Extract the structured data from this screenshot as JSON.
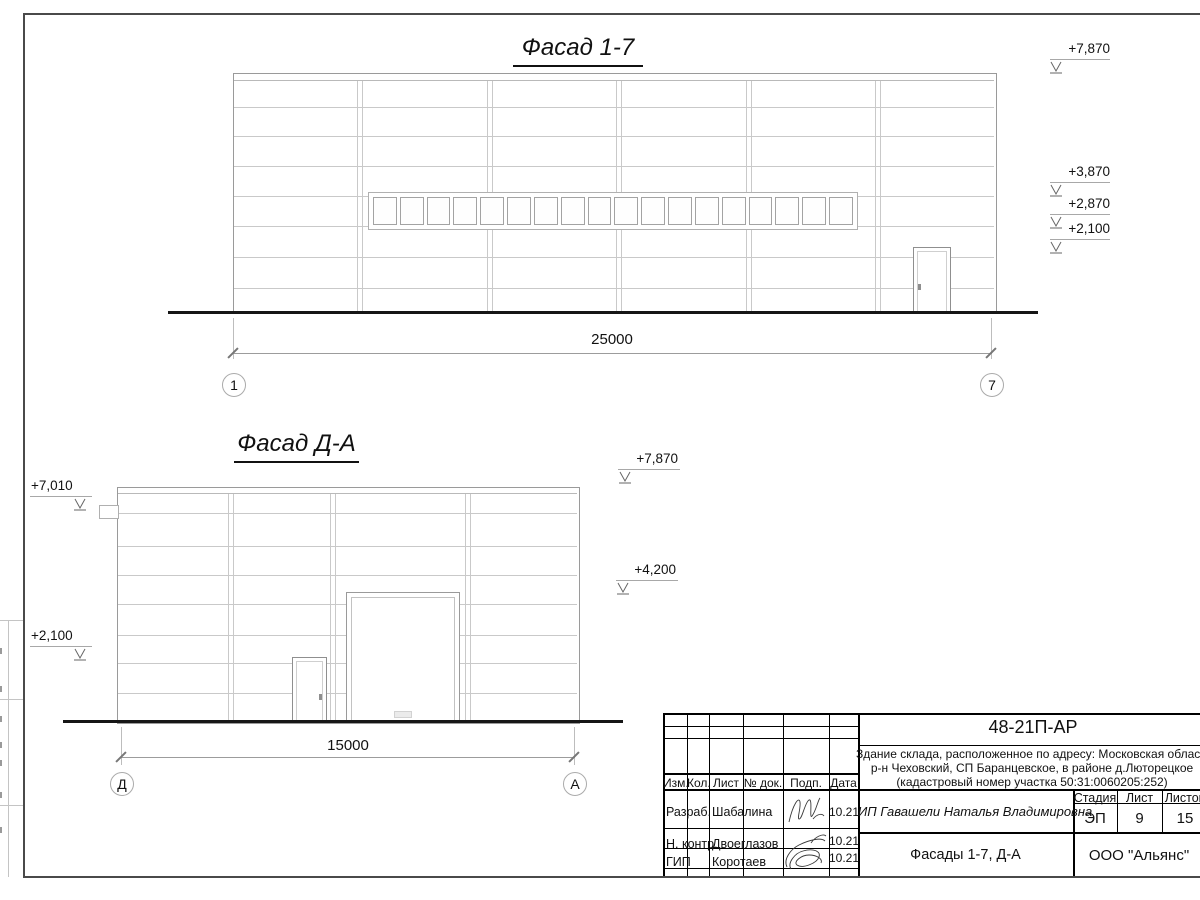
{
  "facade_top": {
    "title": "Фасад 1-7",
    "dimension": "25000",
    "axis_left": "1",
    "axis_right": "7",
    "elev_roof": "+7,870",
    "elev_1": "+3,870",
    "elev_2": "+2,870",
    "elev_3": "+2,100",
    "window_panes": 18
  },
  "facade_side": {
    "title": "Фасад Д-А",
    "dimension": "15000",
    "axis_left": "Д",
    "axis_right": "А",
    "elev_left_top": "+7,010",
    "elev_left_bottom": "+2,100",
    "elev_right_top": "+7,870",
    "elev_right_mid": "+4,200"
  },
  "titleblock": {
    "doc_number": "48-21П-АР",
    "address_line1": "Здание склада, расположенное по адресу: Московская область,",
    "address_line2": "р-н Чеховский, СП Баранцевское, в районе д.Люторецкое",
    "address_line3": "(кадастровый номер участка 50:31:0060205:252)",
    "col_izm": "Изм.",
    "col_kol": "Кол.",
    "col_list": "Лист",
    "col_doc": "№ док.",
    "col_podp": "Подп.",
    "col_data": "Дата",
    "row1_role": "Разраб.",
    "row1_name": "Шабалина",
    "row1_date": "10.21",
    "row2_role": "Н. контр.",
    "row2_name": "Двоеглазов",
    "row2_date": "10.21",
    "row3_role": "ГИП",
    "row3_name": "Коротаев",
    "row3_date": "10.21",
    "client": "ИП Гавашели Наталья Владимировна",
    "stage_label": "Стадия",
    "sheet_label": "Лист",
    "sheets_label": "Листов",
    "stage_value": "ЭП",
    "sheet_value": "9",
    "sheets_value": "15",
    "sheet_title": "Фасады 1-7, Д-А",
    "company": "ООО \"Альянс\""
  }
}
